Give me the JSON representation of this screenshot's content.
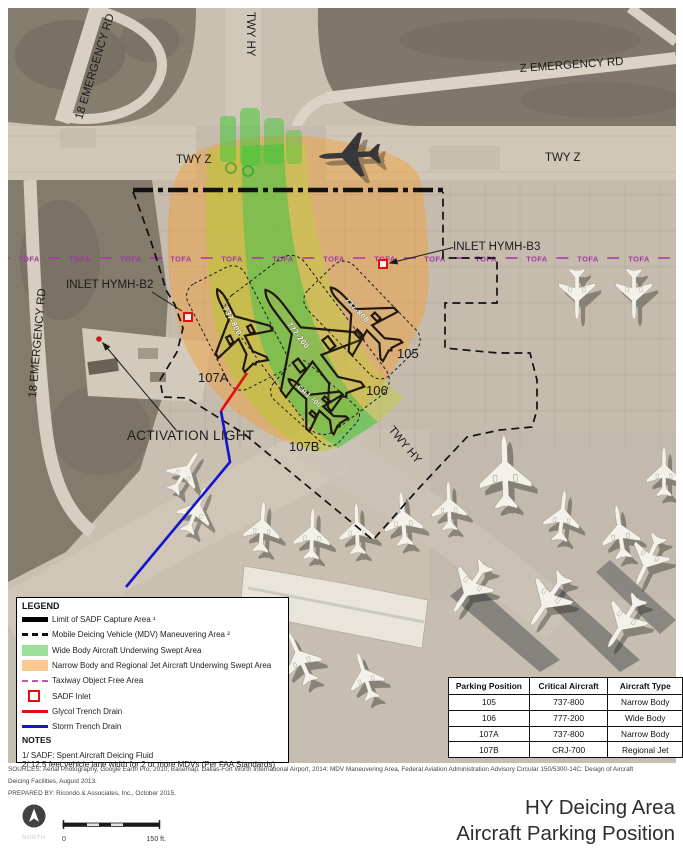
{
  "map": {
    "road_labels": {
      "emergency_rd_18_top": "18 EMERGENCY RD",
      "twy_hy_top": "TWY HY",
      "emergency_rd_z": "Z EMERGENCY RD",
      "twy_z_left": "TWY Z",
      "twy_z_right": "TWY Z",
      "emergency_rd_18_left": "18 EMERGENCY RD",
      "twy_hy_diag": "TWY HY"
    },
    "tofa_label": "TOFA",
    "inlet_b2_label": "INLET HYMH-B2",
    "inlet_b3_label": "INLET HYMH-B3",
    "activation_light_label": "ACTIVATION LIGHT",
    "parking_labels": [
      "105",
      "106",
      "107A",
      "107B"
    ],
    "aircraft_labels": [
      "737-800",
      "777-200",
      "737-800",
      "CRJ-700"
    ]
  },
  "legend": {
    "title": "LEGEND",
    "items": [
      {
        "swatch": "sadf-limit-line",
        "label": "Limit of SADF Capture Area ¹"
      },
      {
        "swatch": "mdv-dashed-line",
        "label": "Mobile Deicing Vehicle (MDV) Maneuvering Area ²"
      },
      {
        "swatch": "widebody-fill",
        "label": "Wide Body Aircraft Underwing Swept Area"
      },
      {
        "swatch": "narrowbody-fill",
        "label": "Narrow Body and Regional Jet Aircraft Underwing Swept Area"
      },
      {
        "swatch": "tofa-line",
        "label": "Taxiway Object Free Area"
      },
      {
        "swatch": "sadf-inlet",
        "label": "SADF Inlet"
      },
      {
        "swatch": "glycol-line",
        "label": "Glycol Trench Drain"
      },
      {
        "swatch": "storm-line",
        "label": "Storm Trench Drain"
      }
    ],
    "notes_title": "NOTES",
    "notes": [
      "1/ SADF: Spent Aircraft Deicing Fluid",
      "2/ 12.5 feet vehicle lane width for 2 or more MDVs (Per FAA Standards)"
    ]
  },
  "table": {
    "headers": [
      "Parking Position",
      "Critical Aircraft",
      "Aircraft Type"
    ],
    "rows": [
      [
        "105",
        "737-800",
        "Narrow Body"
      ],
      [
        "106",
        "777-200",
        "Wide Body"
      ],
      [
        "107A",
        "737-800",
        "Narrow Body"
      ],
      [
        "107B",
        "CRJ-700",
        "Regional Jet"
      ]
    ]
  },
  "footer": {
    "sources_line1": "SOURCES: Aerial Photography, Google Earth Pro, 2010; Basemap, Dallas-Fort Worth International Airport, 2014; MDV Maneuvering Area, Federal Aviation Administration Advisory Circular 150/5300-14C: Design of Aircraft",
    "sources_line2": "Deicing Facilities, August 2013.",
    "prepared_by": "PREPARED BY: Ricondo & Associates, Inc., October 2015.",
    "title_line1": "HY Deicing Area",
    "title_line2": "Aircraft Parking Position",
    "north_label": "NORTH",
    "scale_zero": "0",
    "scale_max": "150 ft."
  },
  "colors": {
    "widebody_green": "#9be09a",
    "narrowbody_orange": "#fbca92",
    "tofa_purple": "#a238a2",
    "sadf_inlet_red": "#e01010",
    "glycol_red": "#e01010",
    "storm_blue": "#1515cc",
    "boundary_black": "#111111"
  }
}
